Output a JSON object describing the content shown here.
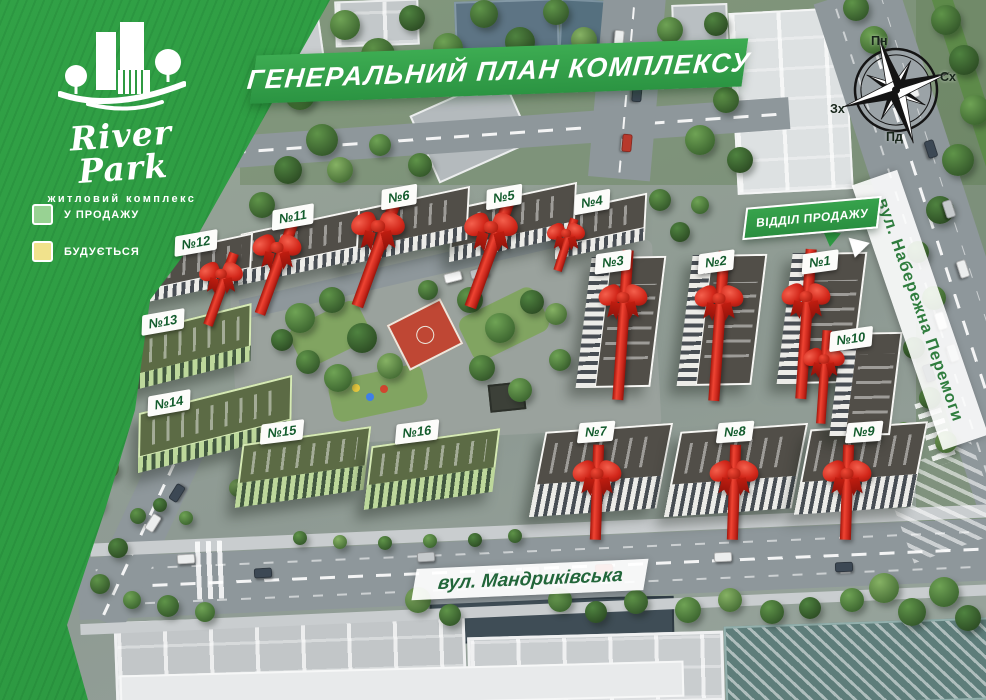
{
  "logo": {
    "name": "River Park",
    "tagline": "житловий комплекс"
  },
  "header": {
    "title": "ГЕНЕРАЛЬНИЙ ПЛАН КОМПЛЕКСУ"
  },
  "legend": {
    "items": [
      {
        "label": "У ПРОДАЖУ",
        "swatch": "#98d293"
      },
      {
        "label": "БУДУЄТЬСЯ",
        "swatch": "#f1e28c"
      }
    ]
  },
  "compass": {
    "north": "Пн",
    "east": "Сх",
    "south": "Пд",
    "west": "Зх"
  },
  "sales_office": {
    "label": "ВІДДІЛ ПРОДАЖУ"
  },
  "streets": {
    "right": "вул. Набережна Перемоги",
    "bottom": "вул. Мандриківська"
  },
  "colors": {
    "poster_green": "#2f9a41",
    "banner_green": "#2b9442",
    "badge_text_green": "#135c2d",
    "bow_red": "#d2271a",
    "sale_swatch": "#98d293",
    "construction_swatch": "#f1e28c"
  },
  "buildings": [
    {
      "label": "№1",
      "type": "white",
      "shape": "v",
      "cx": 822,
      "cy": 318,
      "w": 74,
      "h": 132,
      "rot": 7,
      "badge": {
        "x": 820,
        "y": 262,
        "rot": -8
      },
      "bow": {
        "x": 806,
        "y": 300,
        "rot": 4,
        "len": 150,
        "scale": 1.0
      }
    },
    {
      "label": "№2",
      "type": "white",
      "shape": "v",
      "cx": 722,
      "cy": 320,
      "w": 74,
      "h": 132,
      "rot": 7,
      "badge": {
        "x": 716,
        "y": 262,
        "rot": -8
      },
      "bow": {
        "x": 719,
        "y": 302,
        "rot": 4,
        "len": 150,
        "scale": 1.0
      }
    },
    {
      "label": "№3",
      "type": "white",
      "shape": "v",
      "cx": 621,
      "cy": 322,
      "w": 74,
      "h": 132,
      "rot": 7,
      "badge": {
        "x": 613,
        "y": 262,
        "rot": -8
      },
      "bow": {
        "x": 623,
        "y": 301,
        "rot": 4,
        "len": 150,
        "scale": 1.0
      }
    },
    {
      "label": "№4",
      "type": "white",
      "shape": "h",
      "cx": 601,
      "cy": 226,
      "w": 92,
      "h": 46,
      "rot": -12,
      "badge": {
        "x": 592,
        "y": 202,
        "rot": -10
      },
      "bow": {
        "x": 566,
        "y": 236,
        "rot": 18,
        "len": 70,
        "scale": 0.78
      }
    },
    {
      "label": "№5",
      "type": "white",
      "shape": "h",
      "cx": 513,
      "cy": 222,
      "w": 128,
      "h": 52,
      "rot": -12,
      "badge": {
        "x": 504,
        "y": 197,
        "rot": -10
      },
      "bow": {
        "x": 491,
        "y": 231,
        "rot": 20,
        "len": 110,
        "scale": 1.1
      }
    },
    {
      "label": "№6",
      "type": "white",
      "shape": "h",
      "cx": 406,
      "cy": 226,
      "w": 128,
      "h": 52,
      "rot": -12,
      "badge": {
        "x": 399,
        "y": 197,
        "rot": -10
      },
      "bow": {
        "x": 378,
        "y": 230,
        "rot": 20,
        "len": 110,
        "scale": 1.1
      }
    },
    {
      "label": "№7",
      "type": "white",
      "shape": "b",
      "cx": 601,
      "cy": 470,
      "w": 128,
      "h": 84,
      "rot": -4,
      "badge": {
        "x": 596,
        "y": 432,
        "rot": -4
      },
      "bow": {
        "x": 597,
        "y": 477,
        "rot": 2,
        "len": 95,
        "scale": 1.0
      }
    },
    {
      "label": "№8",
      "type": "white",
      "shape": "b",
      "cx": 736,
      "cy": 470,
      "w": 128,
      "h": 84,
      "rot": -4,
      "badge": {
        "x": 735,
        "y": 432,
        "rot": -4
      },
      "bow": {
        "x": 734,
        "y": 477,
        "rot": 2,
        "len": 95,
        "scale": 1.0
      }
    },
    {
      "label": "№9",
      "type": "white",
      "shape": "b",
      "cx": 861,
      "cy": 468,
      "w": 118,
      "h": 84,
      "rot": -4,
      "badge": {
        "x": 864,
        "y": 432,
        "rot": -4
      },
      "bow": {
        "x": 847,
        "y": 477,
        "rot": 2,
        "len": 95,
        "scale": 1.0
      }
    },
    {
      "label": "№10",
      "type": "white",
      "shape": "v",
      "cx": 866,
      "cy": 384,
      "w": 60,
      "h": 104,
      "rot": 7,
      "badge": {
        "x": 851,
        "y": 339,
        "rot": -8
      },
      "bow": {
        "x": 824,
        "y": 362,
        "rot": 4,
        "len": 110,
        "scale": 0.85
      }
    },
    {
      "label": "№11",
      "type": "white",
      "shape": "h",
      "cx": 299,
      "cy": 247,
      "w": 122,
      "h": 50,
      "rot": -12,
      "badge": {
        "x": 293,
        "y": 217,
        "rot": -10
      },
      "bow": {
        "x": 277,
        "y": 251,
        "rot": 20,
        "len": 100,
        "scale": 1.0
      }
    },
    {
      "label": "№12",
      "type": "white",
      "shape": "h",
      "cx": 197,
      "cy": 268,
      "w": 112,
      "h": 46,
      "rot": -12,
      "badge": {
        "x": 196,
        "y": 243,
        "rot": -10
      },
      "bow": {
        "x": 221,
        "y": 277,
        "rot": 20,
        "len": 85,
        "scale": 0.9
      }
    },
    {
      "label": "№13",
      "type": "green",
      "shape": "h",
      "cx": 187,
      "cy": 348,
      "w": 132,
      "h": 56,
      "rot": -14,
      "badge": {
        "x": 163,
        "y": 322,
        "rot": -10
      }
    },
    {
      "label": "№14",
      "type": "green",
      "shape": "h",
      "cx": 215,
      "cy": 424,
      "w": 158,
      "h": 58,
      "rot": -14,
      "badge": {
        "x": 169,
        "y": 403,
        "rot": -10
      }
    },
    {
      "label": "№15",
      "type": "green",
      "shape": "b",
      "cx": 303,
      "cy": 467,
      "w": 130,
      "h": 62,
      "rot": -8,
      "badge": {
        "x": 282,
        "y": 432,
        "rot": -7
      }
    },
    {
      "label": "№16",
      "type": "green",
      "shape": "b",
      "cx": 432,
      "cy": 469,
      "w": 130,
      "h": 62,
      "rot": -8,
      "badge": {
        "x": 417,
        "y": 432,
        "rot": -7
      }
    }
  ]
}
